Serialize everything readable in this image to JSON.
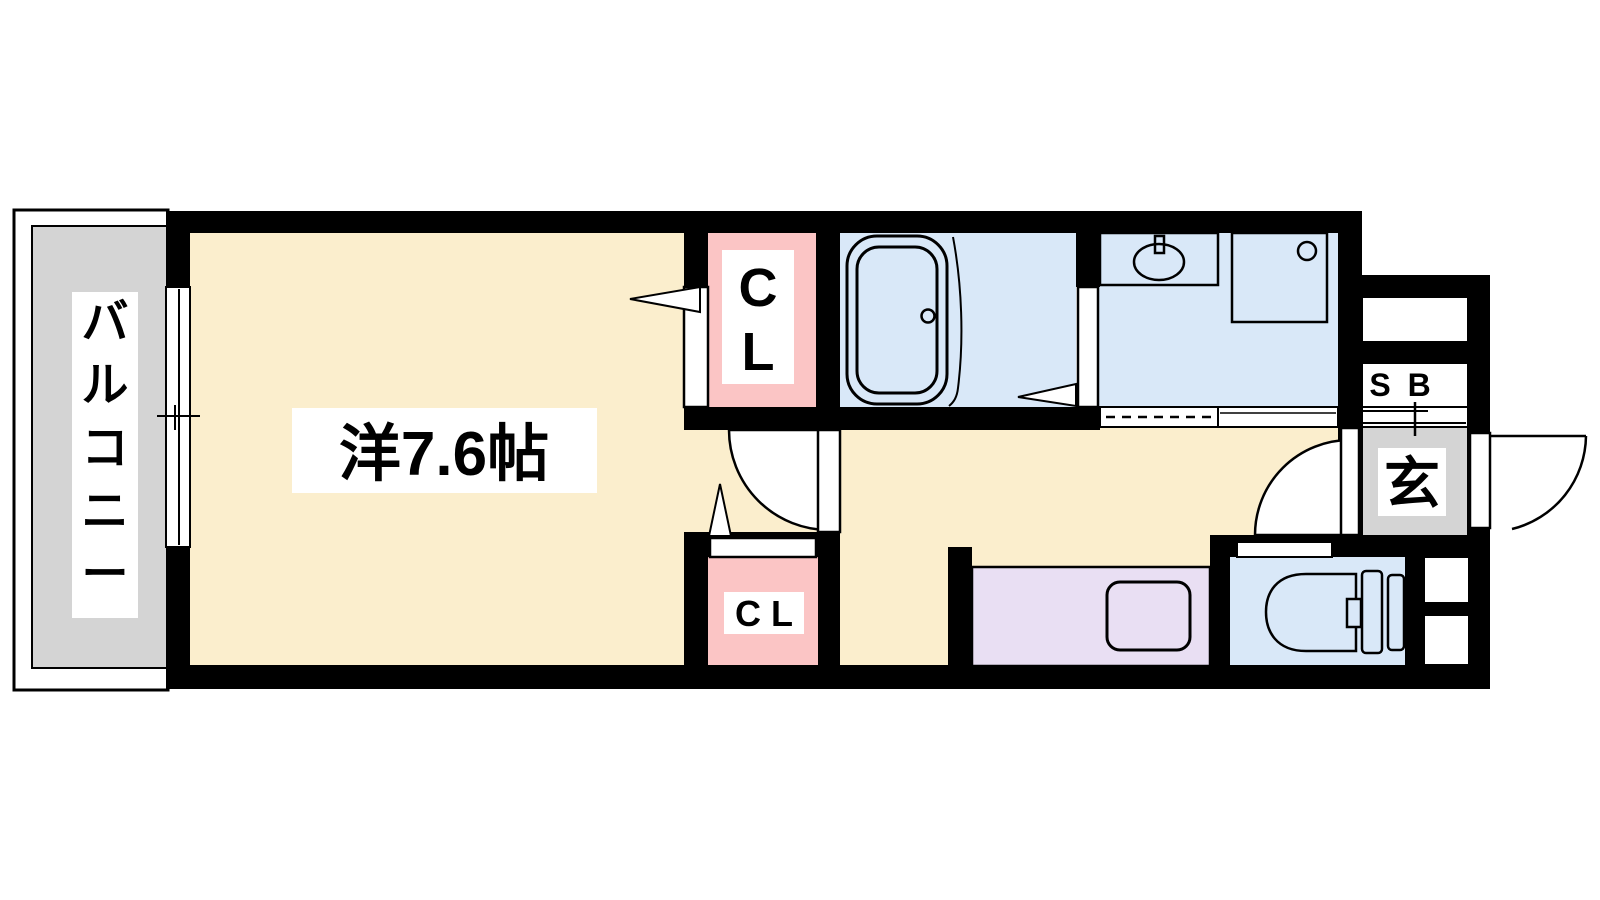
{
  "page": {
    "type": "apartment floor plan",
    "background": "#ffffff"
  },
  "colors": {
    "wall": "#000000",
    "room": "#fbeecd",
    "closet": "#fbc5c5",
    "wet_area": "#d9e8f8",
    "kitchen": "#e9dff3",
    "gray_area": "#d4d4d4",
    "label_bg": "#ffffff",
    "line": "#000000"
  },
  "labels": {
    "balcony": "バルコニー",
    "western_room": "洋7.6帖",
    "closet_upper": "CL",
    "closet_lower": "C L",
    "shoe_box": "S B",
    "entrance": "玄"
  },
  "fixtures": [
    "bathtub-icon",
    "wash-basin-icon",
    "washing-machine-pan-icon",
    "toilet-icon",
    "kitchen-sink-icon",
    "sliding-window-icon",
    "door-swing-arc-icon",
    "folding-door-triangle-icon"
  ]
}
